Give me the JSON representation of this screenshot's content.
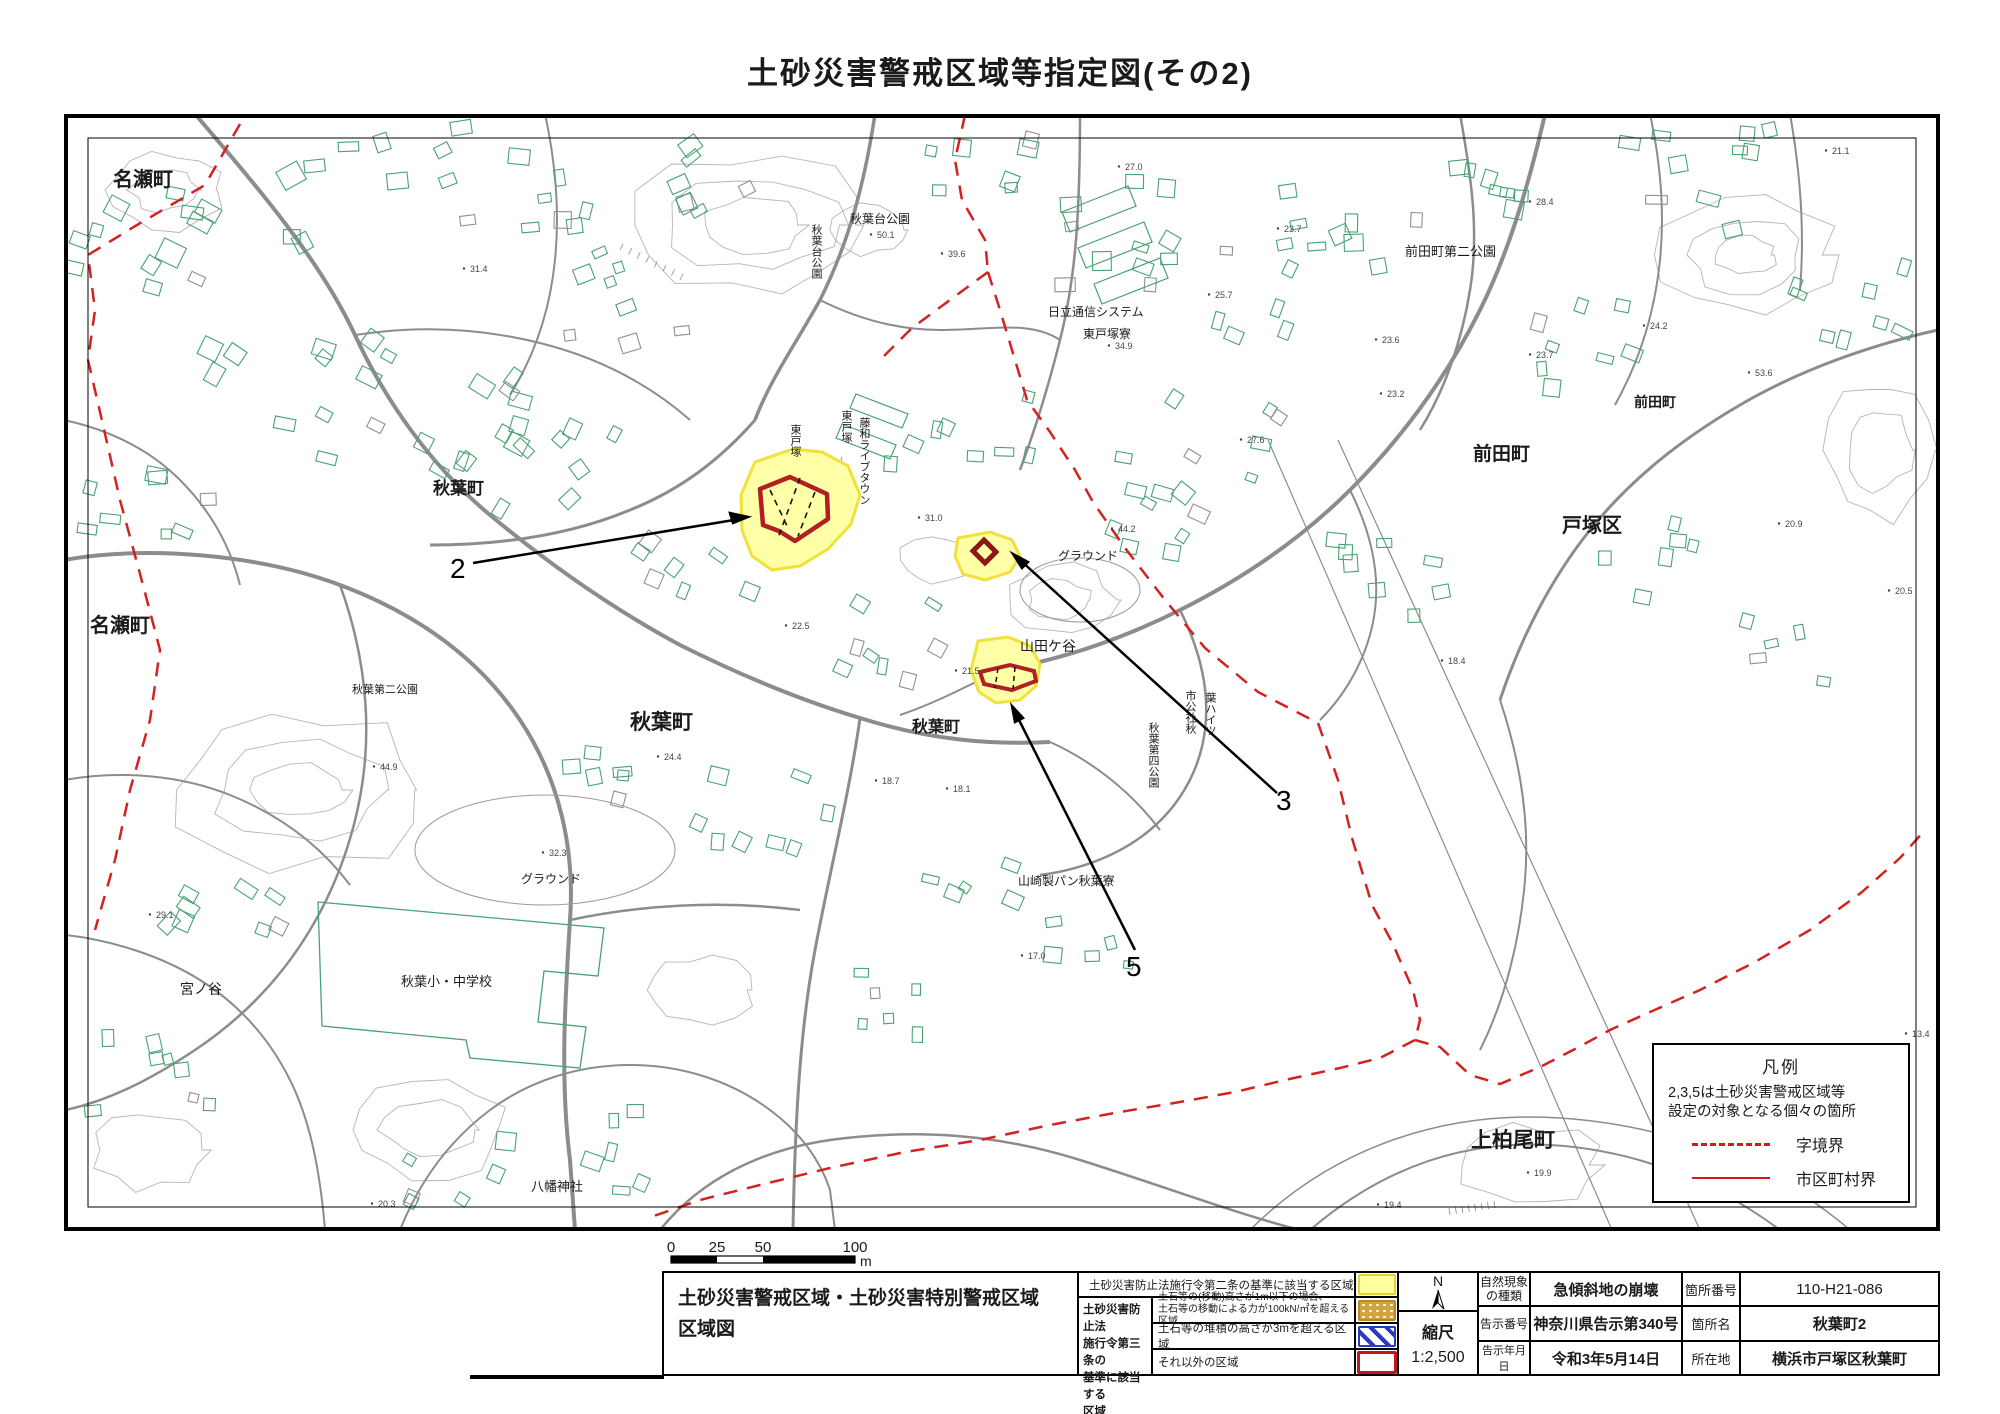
{
  "title": "土砂災害警戒区域等指定図(その2)",
  "map": {
    "place_labels": [
      {
        "text": "名瀬町"
      },
      {
        "text": "名瀬町"
      },
      {
        "text": "秋葉町"
      },
      {
        "text": "秋葉町"
      },
      {
        "text": "秋葉町"
      },
      {
        "text": "秋葉台公園"
      },
      {
        "text": "日立通信システム"
      },
      {
        "text": "東戸塚寮"
      },
      {
        "text": "前田町第二公園"
      },
      {
        "text": "前田町"
      },
      {
        "text": "前田町"
      },
      {
        "text": "戸塚区"
      },
      {
        "text": "グラウンド"
      },
      {
        "text": "山田ケ谷"
      },
      {
        "text": "秋葉第二公園"
      },
      {
        "text": "グラウンド"
      },
      {
        "text": "秋葉小・中学校"
      },
      {
        "text": "宮ノ谷"
      },
      {
        "text": "八幡神社"
      },
      {
        "text": "山崎製パン秋葉寮"
      },
      {
        "text": "上柏尾町"
      },
      {
        "text": "秋葉台公園"
      },
      {
        "text": "東戸塚"
      },
      {
        "text": "東戸塚"
      },
      {
        "text": "藤和ライブタウン"
      },
      {
        "text": "市公社秋"
      },
      {
        "text": "葉ハイツ"
      },
      {
        "text": "秋葉第四公園"
      }
    ],
    "zone_markers": [
      {
        "label": "2"
      },
      {
        "label": "3"
      },
      {
        "label": "5"
      }
    ],
    "spot_elevations": [
      "27.0",
      "31.4",
      "21.1",
      "28.4",
      "23.7",
      "50.1",
      "39.6",
      "34.9",
      "25.7",
      "27.6",
      "23.6",
      "23.2",
      "24.2",
      "23.7",
      "53.6",
      "20.9",
      "20.5",
      "31.0",
      "44.2",
      "18.4",
      "22.5",
      "21.5",
      "24.4",
      "44.9",
      "32.3",
      "18.7",
      "18.1",
      "17.0",
      "29.1",
      "20.3",
      "19.9",
      "19.4",
      "13.4"
    ]
  },
  "scale_bar": {
    "ticks": [
      "0",
      "25",
      "50",
      "100"
    ],
    "unit": "m"
  },
  "legend_box": {
    "title": "凡例",
    "note_line1": "2,3,5は土砂災害警戒区域等",
    "note_line2": "設定の対象となる個々の箇所",
    "items": [
      {
        "label": "字境界"
      },
      {
        "label": "市区町村界"
      }
    ]
  },
  "table": {
    "map_title_line1": "土砂災害警戒区域・土砂災害特別警戒区域",
    "map_title_line2": "区域図",
    "legend": {
      "row1_text": "土砂災害防止法施行令第二条の基準に該当する区域",
      "group_line1": "土砂災害防止法",
      "group_line2": "施行令第三条の",
      "group_line3": "基準に該当する",
      "group_line4": "区域",
      "row2_line1": "土石等の(移動)高さが1m以下の場合、",
      "row2_line2": "土石等の移動による力が100kN/㎡を超える区域",
      "row3_text": "土石等の堆積の高さが3mを超える区域",
      "row4_text": "それ以外の区域"
    },
    "north_label": "N",
    "scale_label": "縮尺",
    "scale_value": "1:2,500",
    "info": {
      "r1c1a": "自然現象",
      "r1c1b": "の種類",
      "r1c2": "急傾斜地の崩壊",
      "r1c3": "箇所番号",
      "r1c4": "110-H21-086",
      "r2c1": "告示番号",
      "r2c2": "神奈川県告示第340号",
      "r2c3": "箇所名",
      "r2c4": "秋葉町2",
      "r3c1": "告示年月日",
      "r3c2": "令和3年5月14日",
      "r3c3": "所在地",
      "r3c4": "横浜市戸塚区秋葉町"
    }
  }
}
